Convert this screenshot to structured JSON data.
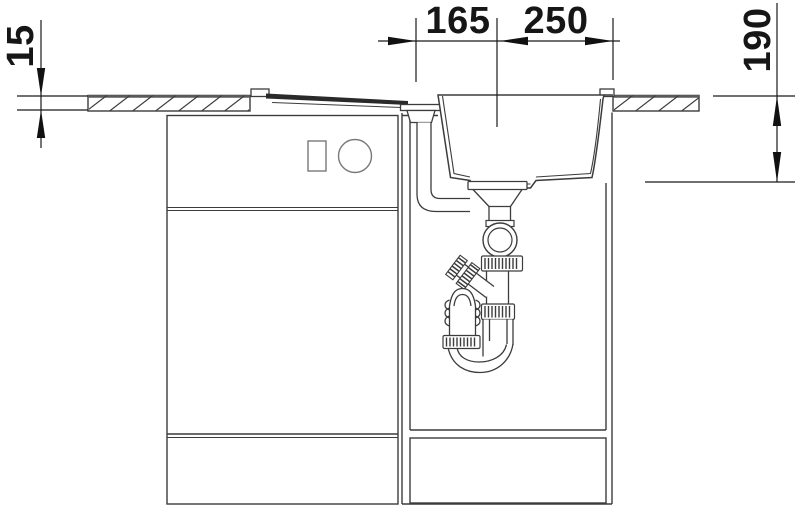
{
  "drawing": {
    "kind": "sink installation section drawing",
    "dimensions": {
      "top_left_span": "165",
      "top_right_span": "250",
      "countertop_thickness": "15",
      "bowl_depth": "190"
    },
    "colors": {
      "background": "#ffffff",
      "line": "#3c3c3c",
      "dim_line": "#1a1a1a",
      "section_fill_dark": "#2a2a2a",
      "slab_edge": "#5a5a5a",
      "socket_line": "#787878"
    }
  }
}
